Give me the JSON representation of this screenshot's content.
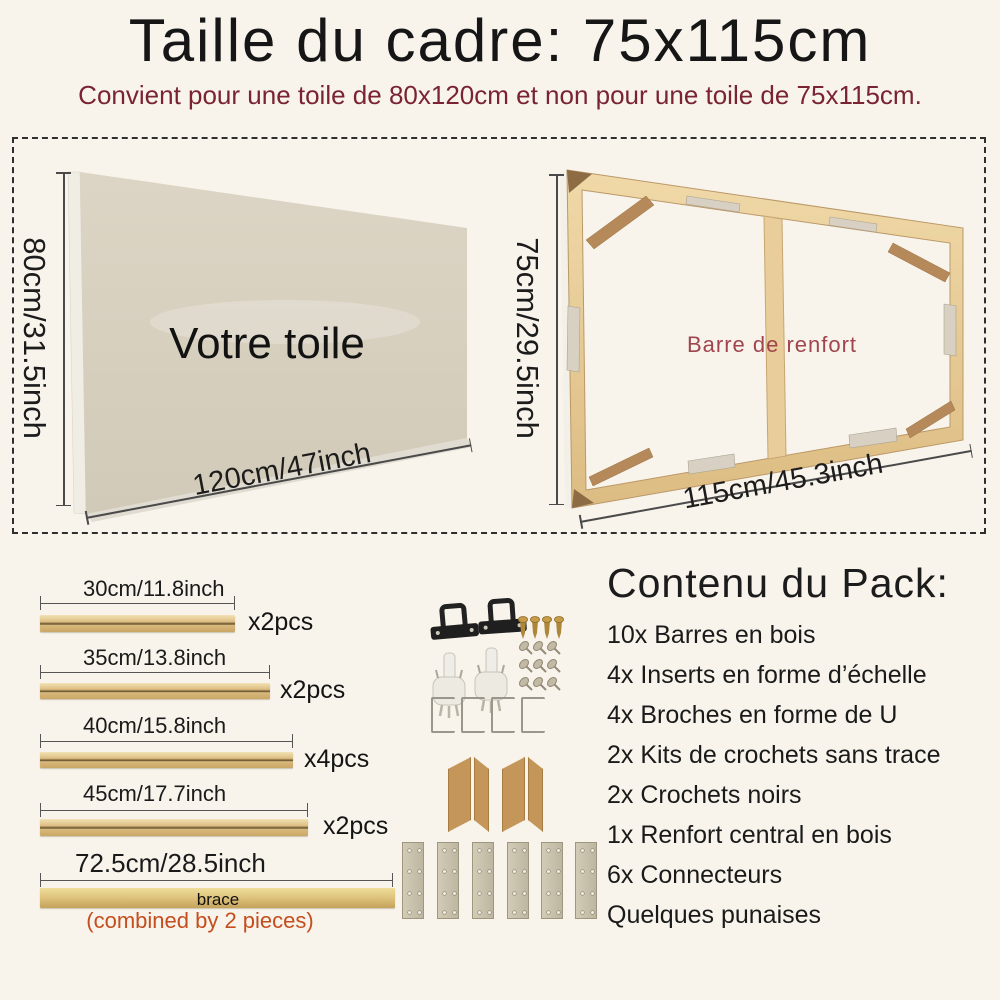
{
  "title": "Taille du cadre: 75x115cm",
  "subtitle": "Convient pour une toile de 80x120cm et non pour une toile de 75x115cm.",
  "canvas_diagram": {
    "label": "Votre toile",
    "height_label": "80cm/31.5inch",
    "width_label": "120cm/47inch"
  },
  "frame_diagram": {
    "label": "Barre de renfort",
    "height_label": "75cm/29.5inch",
    "width_label": "115cm/45.3inch"
  },
  "bars": [
    {
      "size": "30cm/11.8inch",
      "qty": "x2pcs"
    },
    {
      "size": "35cm/13.8inch",
      "qty": "x2pcs"
    },
    {
      "size": "40cm/15.8inch",
      "qty": "x4pcs"
    },
    {
      "size": "45cm/17.7inch",
      "qty": "x2pcs"
    },
    {
      "size": "72.5cm/28.5inch",
      "bar_label": "brace",
      "note": "(combined by 2 pieces)"
    }
  ],
  "pack": {
    "heading": "Contenu du Pack:",
    "items": [
      "10x Barres en bois",
      "4x Inserts en forme d’échelle",
      "4x Broches en forme de U",
      "2x Kits de crochets sans trace",
      "2x Crochets noirs",
      "1x Renfort central en bois",
      "6x Connecteurs",
      "Quelques punaises"
    ]
  },
  "hardware_icons": {
    "black_hook": 2,
    "screw": 4,
    "pin": 9,
    "white_hook": 2,
    "u_bracket": 4,
    "wood_insert": 4,
    "connector_plate": 6
  },
  "colors": {
    "background": "#f8f4ec",
    "title": "#161616",
    "subtitle_red": "#7a2433",
    "frame_label_red": "#a0454d",
    "note_orange": "#c44e1d",
    "wood": "#e7cb95",
    "wood_dark": "#b5895a",
    "canvas": "#d8d0bf",
    "metal": "#d6cfc2",
    "connector": "#c8c1ab"
  }
}
